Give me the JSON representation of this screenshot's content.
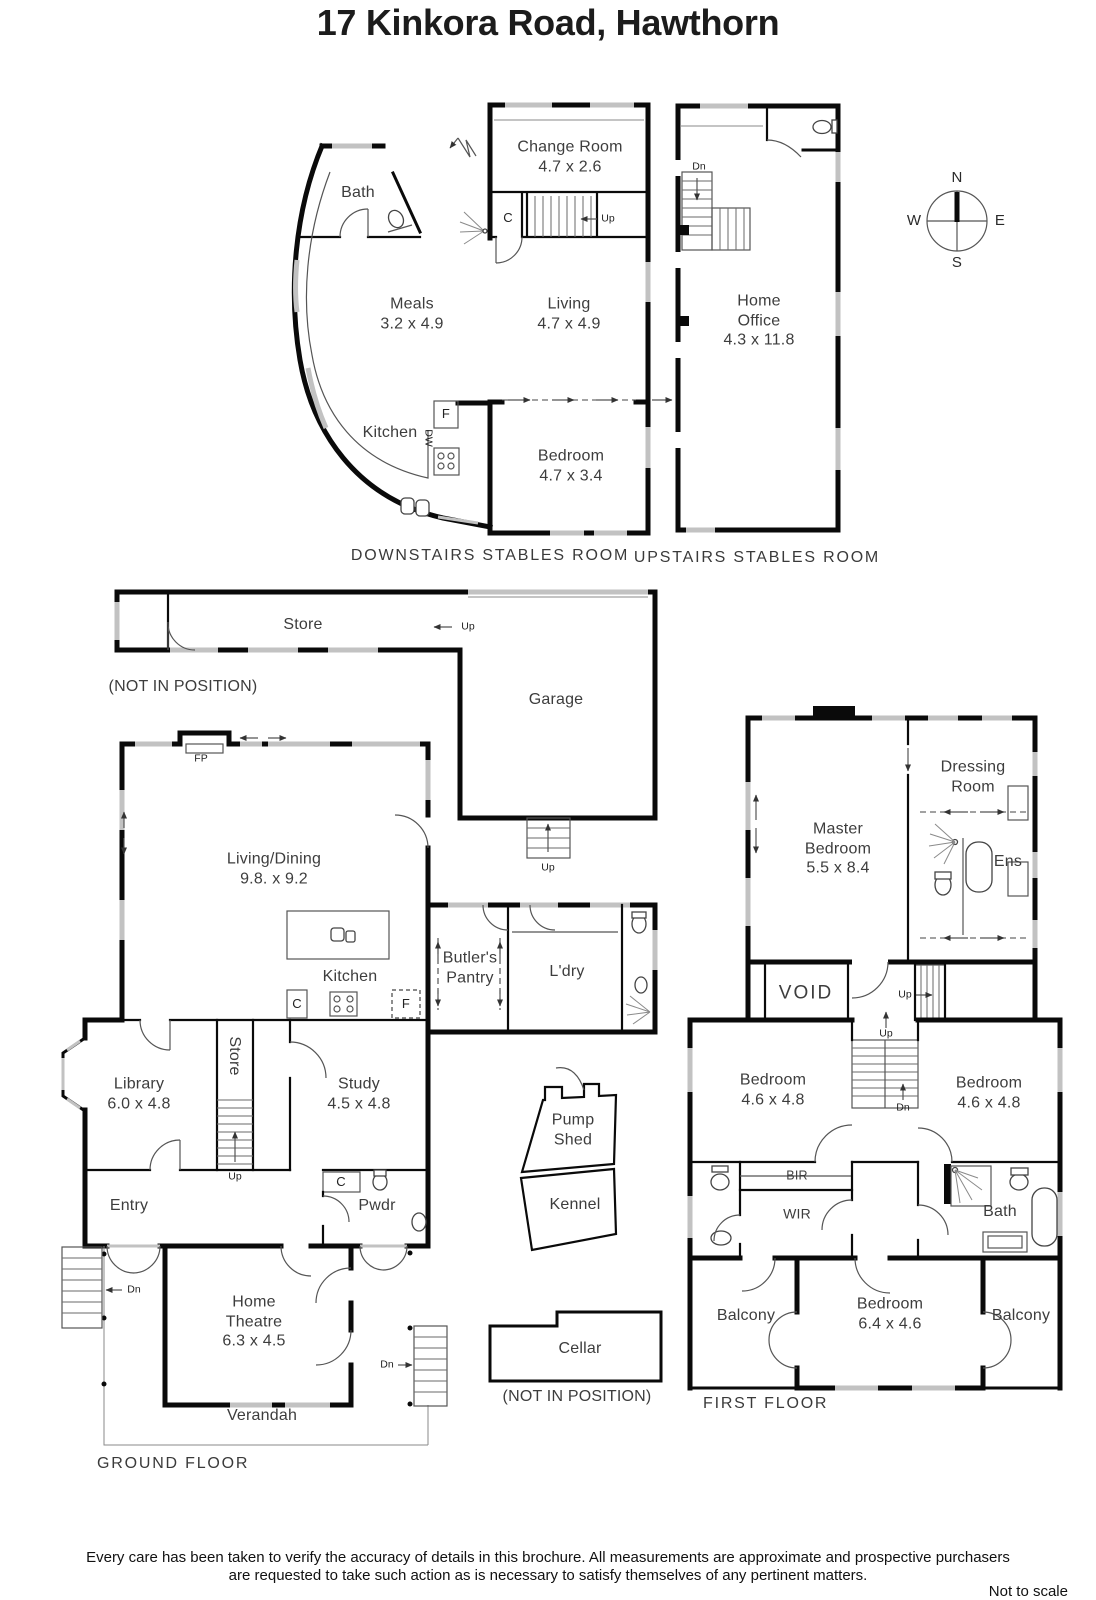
{
  "title": "17 Kinkora Road, Hawthorn",
  "compass": {
    "north": "N",
    "south": "S",
    "east": "E",
    "west": "W"
  },
  "downstairs_stables": {
    "caption": "DOWNSTAIRS STABLES ROOM",
    "rooms": {
      "bath": "Bath",
      "change_room": "Change Room\n4.7 x 2.6",
      "meals": "Meals\n3.2 x 4.9",
      "living": "Living\n4.7 x 4.9",
      "kitchen": "Kitchen",
      "bedroom": "Bedroom\n4.7 x 3.4"
    },
    "markers": {
      "closet": "C",
      "fridge": "F",
      "dishwasher": "DW",
      "up": "Up"
    }
  },
  "upstairs_stables": {
    "caption": "UPSTAIRS STABLES ROOM",
    "rooms": {
      "home_office": "Home\nOffice\n4.3 x 11.8"
    },
    "markers": {
      "down": "Dn"
    }
  },
  "ground_floor": {
    "caption": "GROUND FLOOR",
    "store_note": "(NOT IN POSITION)",
    "cellar_note": "(NOT IN POSITION)",
    "rooms": {
      "store": "Store",
      "garage": "Garage",
      "living_dining": "Living/Dining\n9.8. x 9.2",
      "kitchen": "Kitchen",
      "butlers_pantry": "Butler's\nPantry",
      "laundry": "L'dry",
      "library": "Library\n6.0 x 4.8",
      "stair_store": "Store",
      "study": "Study\n4.5 x 4.8",
      "entry": "Entry",
      "powder": "Pwdr",
      "pump_shed": "Pump\nShed",
      "kennel": "Kennel",
      "home_theatre": "Home\nTheatre\n6.3 x 4.5",
      "cellar": "Cellar",
      "verandah": "Verandah"
    },
    "markers": {
      "fireplace": "FP",
      "closet_kitchen": "C",
      "fridge": "F",
      "closet_entry": "C",
      "up_store": "Up",
      "up_garage": "Up",
      "up_stairs": "Up",
      "down_west": "Dn",
      "down_south": "Dn"
    }
  },
  "first_floor": {
    "caption": "FIRST FLOOR",
    "rooms": {
      "master_bedroom": "Master\nBedroom\n5.5 x 8.4",
      "dressing_room": "Dressing\nRoom",
      "ensuite": "Ens",
      "void": "VOID",
      "bedroom_left": "Bedroom\n4.6 x 4.8",
      "bedroom_right": "Bedroom\n4.6 x 4.8",
      "built_in_robe": "BIR",
      "walk_in_robe": "WIR",
      "bathroom": "Bath",
      "balcony_left": "Balcony",
      "bedroom_rear": "Bedroom\n6.4 x 4.6",
      "balcony_right": "Balcony"
    },
    "markers": {
      "up_landing": "Up",
      "up_stairs": "Up",
      "down_stairs": "Dn"
    }
  },
  "footer": {
    "disclaimer_line1": "Every care has been taken to verify the accuracy of details in this brochure.  All measurements are approximate and prospective purchasers",
    "disclaimer_line2": "are requested to take such action as is necessary to satisfy themselves of any pertinent matters.",
    "scale_note": "Not to scale"
  },
  "colors": {
    "wall": "#0a0a0a",
    "window": "#c2c2c2",
    "label_text": "#3d3d3d"
  }
}
